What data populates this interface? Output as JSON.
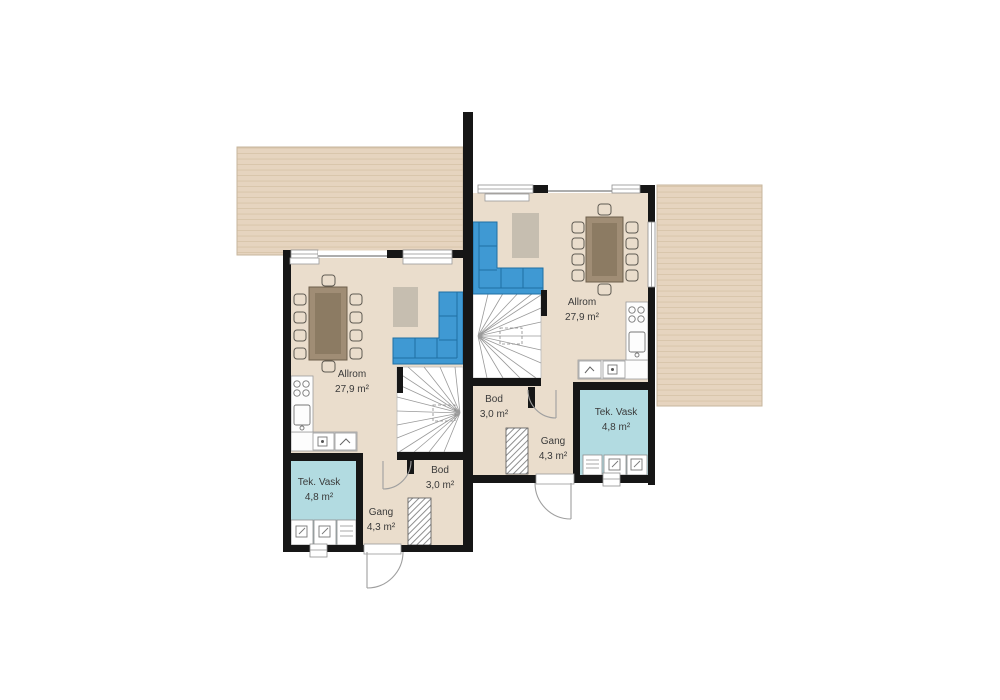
{
  "plan_title": "Duplex floor plan",
  "colors": {
    "background": "#ffffff",
    "wall": "#161616",
    "floor": "#eaddcc",
    "deck": "#e6d4bf",
    "deck_line": "#d8c4aa",
    "tek_vask_floor": "#b2dbe1",
    "sofa": "#3f99d3",
    "sofa_line": "#1f6fa3",
    "rug": "#c6beb0",
    "table": "#a08d75",
    "table_inner": "#8c7b63",
    "stair_line": "#9a9a9a",
    "door_line": "#9f9f9f",
    "label_text": "#3a3a3a"
  },
  "units": [
    {
      "id": "left",
      "rooms": {
        "allrom": {
          "name": "Allrom",
          "area": "27,9 m²"
        },
        "bod": {
          "name": "Bod",
          "area": "3,0 m²"
        },
        "gang": {
          "name": "Gang",
          "area": "4,3 m²"
        },
        "tek_vask": {
          "name": "Tek. Vask",
          "area": "4,8 m²"
        }
      }
    },
    {
      "id": "right",
      "rooms": {
        "allrom": {
          "name": "Allrom",
          "area": "27,9 m²"
        },
        "bod": {
          "name": "Bod",
          "area": "3,0 m²"
        },
        "gang": {
          "name": "Gang",
          "area": "4,3 m²"
        },
        "tek_vask": {
          "name": "Tek. Vask",
          "area": "4,8 m²"
        }
      }
    }
  ]
}
